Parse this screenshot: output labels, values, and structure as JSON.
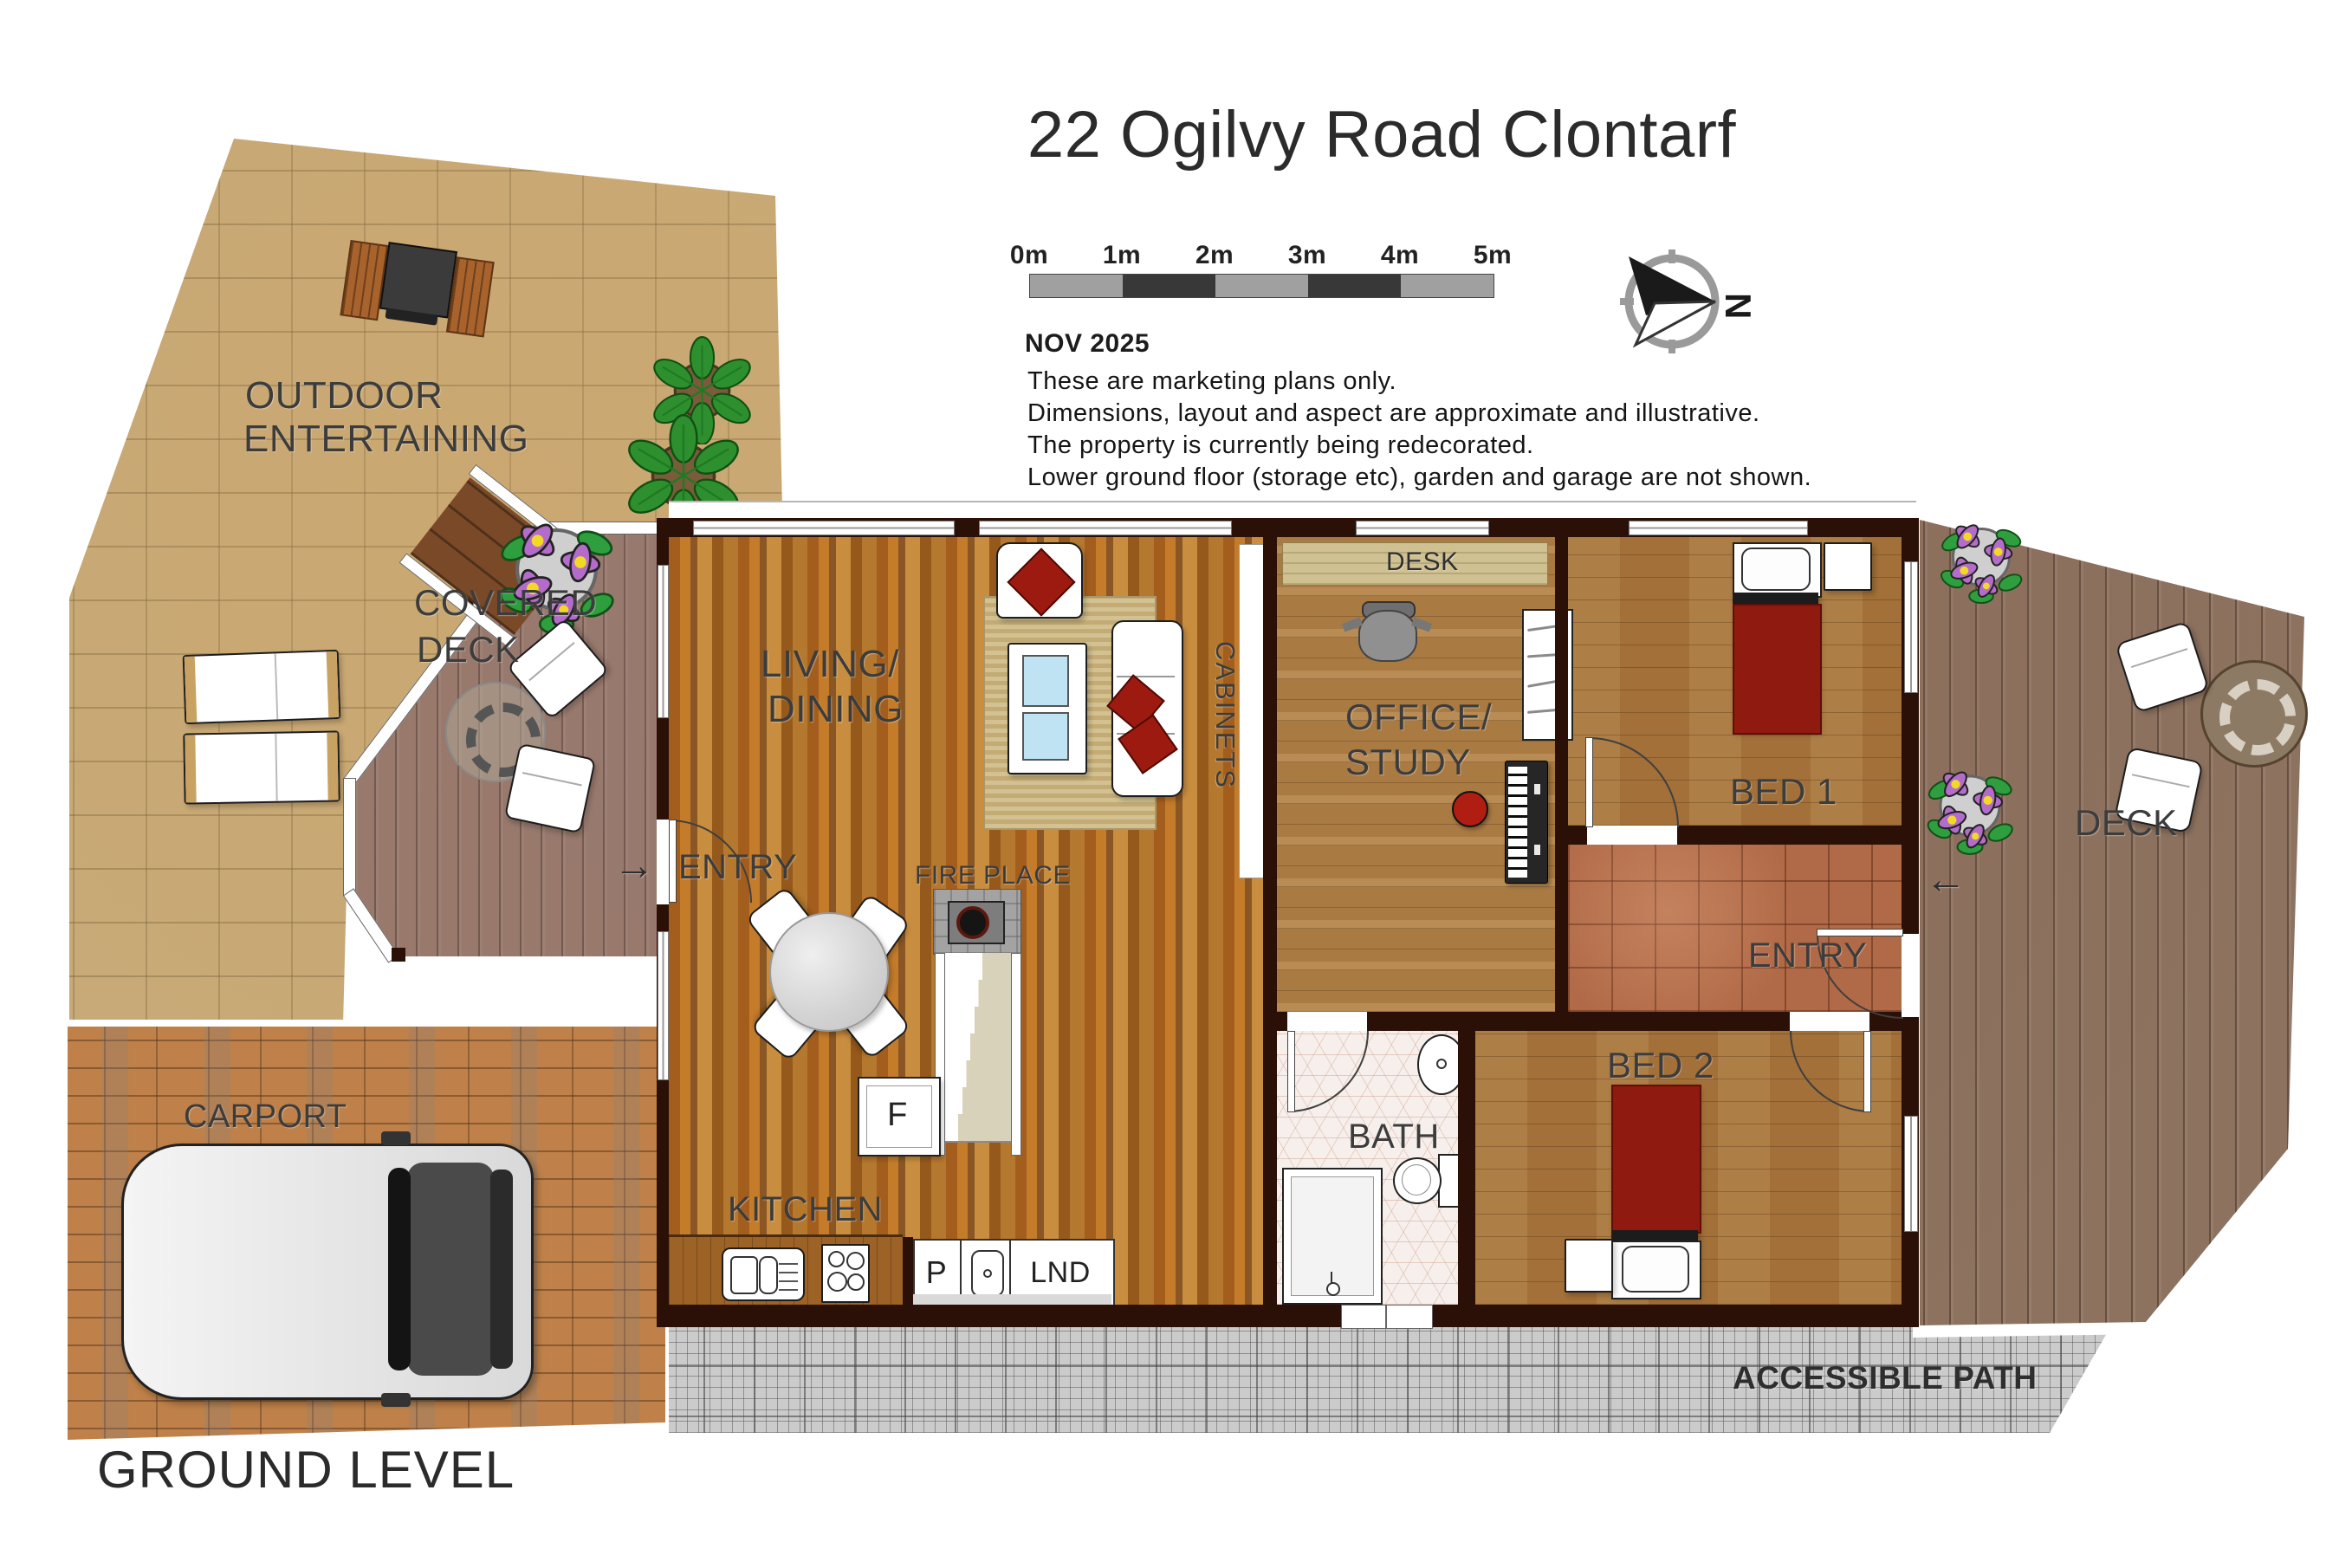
{
  "header": {
    "title": "22 Ogilvy Road Clontarf",
    "date": "NOV 2025",
    "disclaimer": [
      "These are marketing plans only.",
      "Dimensions, layout and aspect are approximate and illustrative.",
      "The property is currently being redecorated.",
      "Lower ground floor (storage etc), garden and garage are not shown."
    ],
    "scale_labels": [
      "0m",
      "1m",
      "2m",
      "3m",
      "4m",
      "5m"
    ],
    "compass_north": "N"
  },
  "rooms": {
    "outdoor_entertaining": [
      "OUTDOOR",
      "ENTERTAINING"
    ],
    "covered_deck": [
      "COVERED",
      "DECK"
    ],
    "carport": "CARPORT",
    "living_dining": [
      "LIVING/",
      "DINING"
    ],
    "entry_left": "ENTRY",
    "fire_place": "FIRE PLACE",
    "kitchen": "KITCHEN",
    "cabinets": "CABINETS",
    "desk": "DESK",
    "office_study": [
      "OFFICE/",
      "STUDY"
    ],
    "bath": "BATH",
    "bed1": "BED 1",
    "bed2": "BED 2",
    "entry_right": "ENTRY",
    "deck_right": "DECK",
    "accessible_path": "ACCESSIBLE PATH"
  },
  "appliances": {
    "fridge": "F",
    "pantry": "P",
    "laundry": "LND"
  },
  "arrows": {
    "entry_left": "→",
    "entry_right": "←"
  },
  "footer": {
    "level": "GROUND LEVEL"
  },
  "colors": {
    "wall": "#2a1006",
    "bed_red": "#8f1a10",
    "label_gray": "#3c3c3c"
  }
}
